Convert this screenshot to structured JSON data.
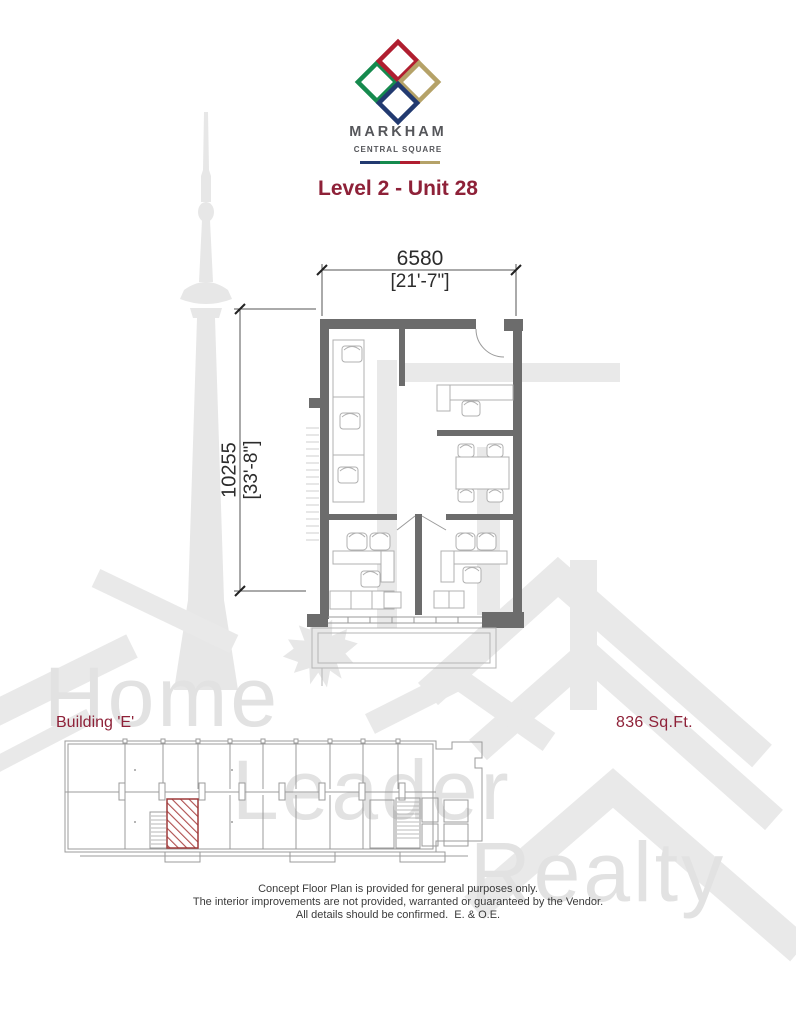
{
  "brand": {
    "name": "MARKHAM",
    "tagline": "CENTRAL SQUARE",
    "diamond_colors": {
      "top": "#b01e30",
      "left": "#168a4e",
      "right": "#b5a268",
      "bottom": "#223a70"
    },
    "bar_colors": [
      "#223a70",
      "#168a4e",
      "#b01e30",
      "#b5a268"
    ]
  },
  "page_title": "Level 2 - Unit 28",
  "plan": {
    "width_metric": "6580",
    "width_imperial": "[21'-7\"]",
    "height_metric": "10255",
    "height_imperial": "[33'-8\"]"
  },
  "unit_info": {
    "building_label": "Building 'E'",
    "area_label": "836 Sq.Ft."
  },
  "watermark": {
    "words": [
      "Home",
      "Leader",
      "Realty"
    ]
  },
  "disclaimer": {
    "lines": [
      "Concept Floor Plan is provided for general purposes only.",
      "The interior improvements are not provided, warranted or guaranteed by the Vendor.",
      "All details should be confirmed.  E. & O.E."
    ]
  },
  "colors": {
    "accent_red": "#8e2138",
    "wall_gray": "#6c6c6c",
    "furniture_gray": "#b0b0b0",
    "watermark_gray": "#e7e7e7",
    "footprint_gray": "#9b9b9b",
    "hatch_red": "#9e3a3a"
  }
}
